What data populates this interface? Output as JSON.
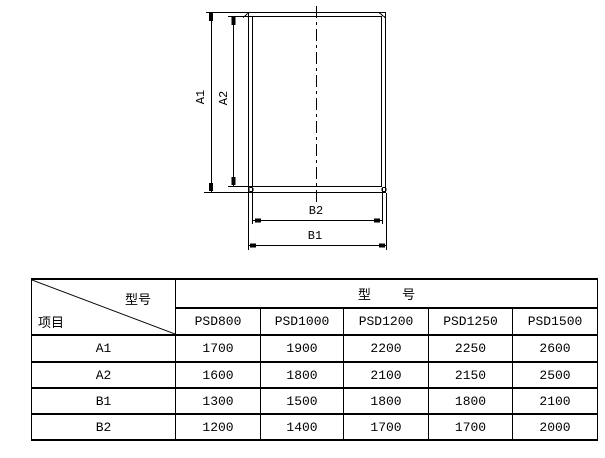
{
  "drawing": {
    "labels": {
      "a1": "A1",
      "a2": "A2",
      "b1": "B1",
      "b2": "B2"
    }
  },
  "table": {
    "corner": {
      "top_right": "型号",
      "bottom_left": "项目"
    },
    "group_header": "型    号",
    "columns": [
      "PSD800",
      "PSD1000",
      "PSD1200",
      "PSD1250",
      "PSD1500"
    ],
    "rows": [
      {
        "label": "A1",
        "values": [
          "1700",
          "1900",
          "2200",
          "2250",
          "2600"
        ]
      },
      {
        "label": "A2",
        "values": [
          "1600",
          "1800",
          "2100",
          "2150",
          "2500"
        ]
      },
      {
        "label": "B1",
        "values": [
          "1300",
          "1500",
          "1800",
          "1800",
          "2100"
        ]
      },
      {
        "label": "B2",
        "values": [
          "1200",
          "1400",
          "1700",
          "1700",
          "2000"
        ]
      }
    ]
  },
  "colors": {
    "background": "#ffffff",
    "line": "#000000"
  }
}
